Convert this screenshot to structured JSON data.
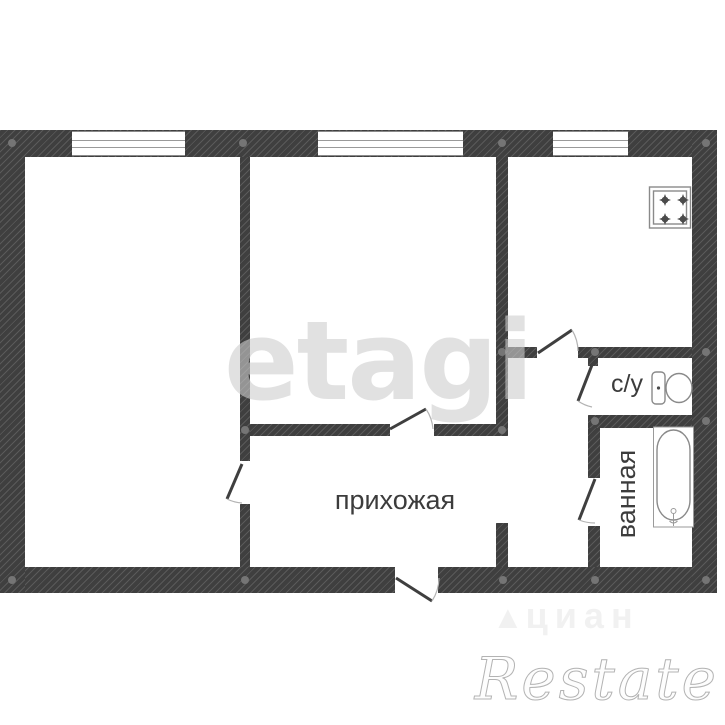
{
  "colors": {
    "background": "#ffffff",
    "wall": "#3f3f3f",
    "line": "#8a8a8a",
    "arc": "#b3b3b3",
    "label_text": "#3c3c3c",
    "watermark_etagi": "rgba(205,205,205,0.6)",
    "watermark_restate": "#fdfdfd",
    "watermark_restate_stroke": "#b3b3b3",
    "watermark_portal": "#f1f1f1"
  },
  "labels": {
    "hallway": "прихожая",
    "wc": "с/у",
    "bathroom": "ванная"
  },
  "watermarks": {
    "etagi": "etagi",
    "restate": "Restate",
    "portal": "циан",
    "portal_icon": "▲"
  },
  "icons": {
    "stove": "stove-icon",
    "toilet": "toilet-icon",
    "bathtub": "bathtub-icon",
    "door": "door-swing-icon",
    "window": "window-icon"
  }
}
